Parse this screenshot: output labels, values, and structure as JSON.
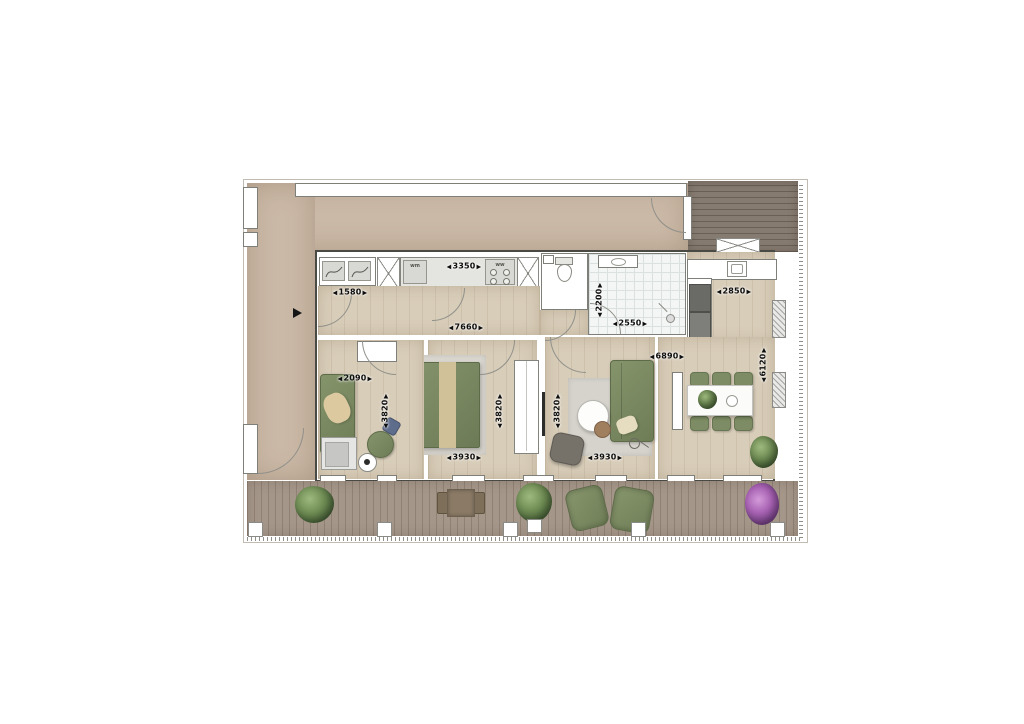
{
  "plan_type": "apartment-floor-plan",
  "appliances": {
    "washing_machine": "wm",
    "water_heater": "ww"
  },
  "dimensions": [
    {
      "value": "3350",
      "orientation": "horizontal",
      "location": "kitchen-counter"
    },
    {
      "value": "1580",
      "orientation": "horizontal",
      "location": "entry-hall"
    },
    {
      "value": "7660",
      "orientation": "horizontal",
      "location": "hallway"
    },
    {
      "value": "2200",
      "orientation": "vertical",
      "location": "bathroom"
    },
    {
      "value": "2550",
      "orientation": "horizontal",
      "location": "bathroom"
    },
    {
      "value": "2850",
      "orientation": "horizontal",
      "location": "kitchen"
    },
    {
      "value": "6890",
      "orientation": "horizontal",
      "location": "living-dining"
    },
    {
      "value": "6120",
      "orientation": "vertical",
      "location": "living-dining"
    },
    {
      "value": "2090",
      "orientation": "horizontal",
      "location": "study"
    },
    {
      "value": "3820",
      "orientation": "vertical",
      "location": "study"
    },
    {
      "value": "3820",
      "orientation": "vertical",
      "location": "bedroom"
    },
    {
      "value": "3820",
      "orientation": "vertical",
      "location": "living-room"
    },
    {
      "value": "3930",
      "orientation": "horizontal",
      "location": "bedroom"
    },
    {
      "value": "3930",
      "orientation": "horizontal",
      "location": "living-room"
    }
  ],
  "colors": {
    "walkway_beige": "#cbb9a7",
    "interior_wood": "#d8cdb9",
    "terrace_deck": "#a49689",
    "roof_deck_dark": "#867b70",
    "furniture_green": "#7b8a63",
    "bathroom_tile": "#f4f6f5",
    "flower_purple": "#a863b3",
    "dimension_text": "#0d0d0d"
  }
}
